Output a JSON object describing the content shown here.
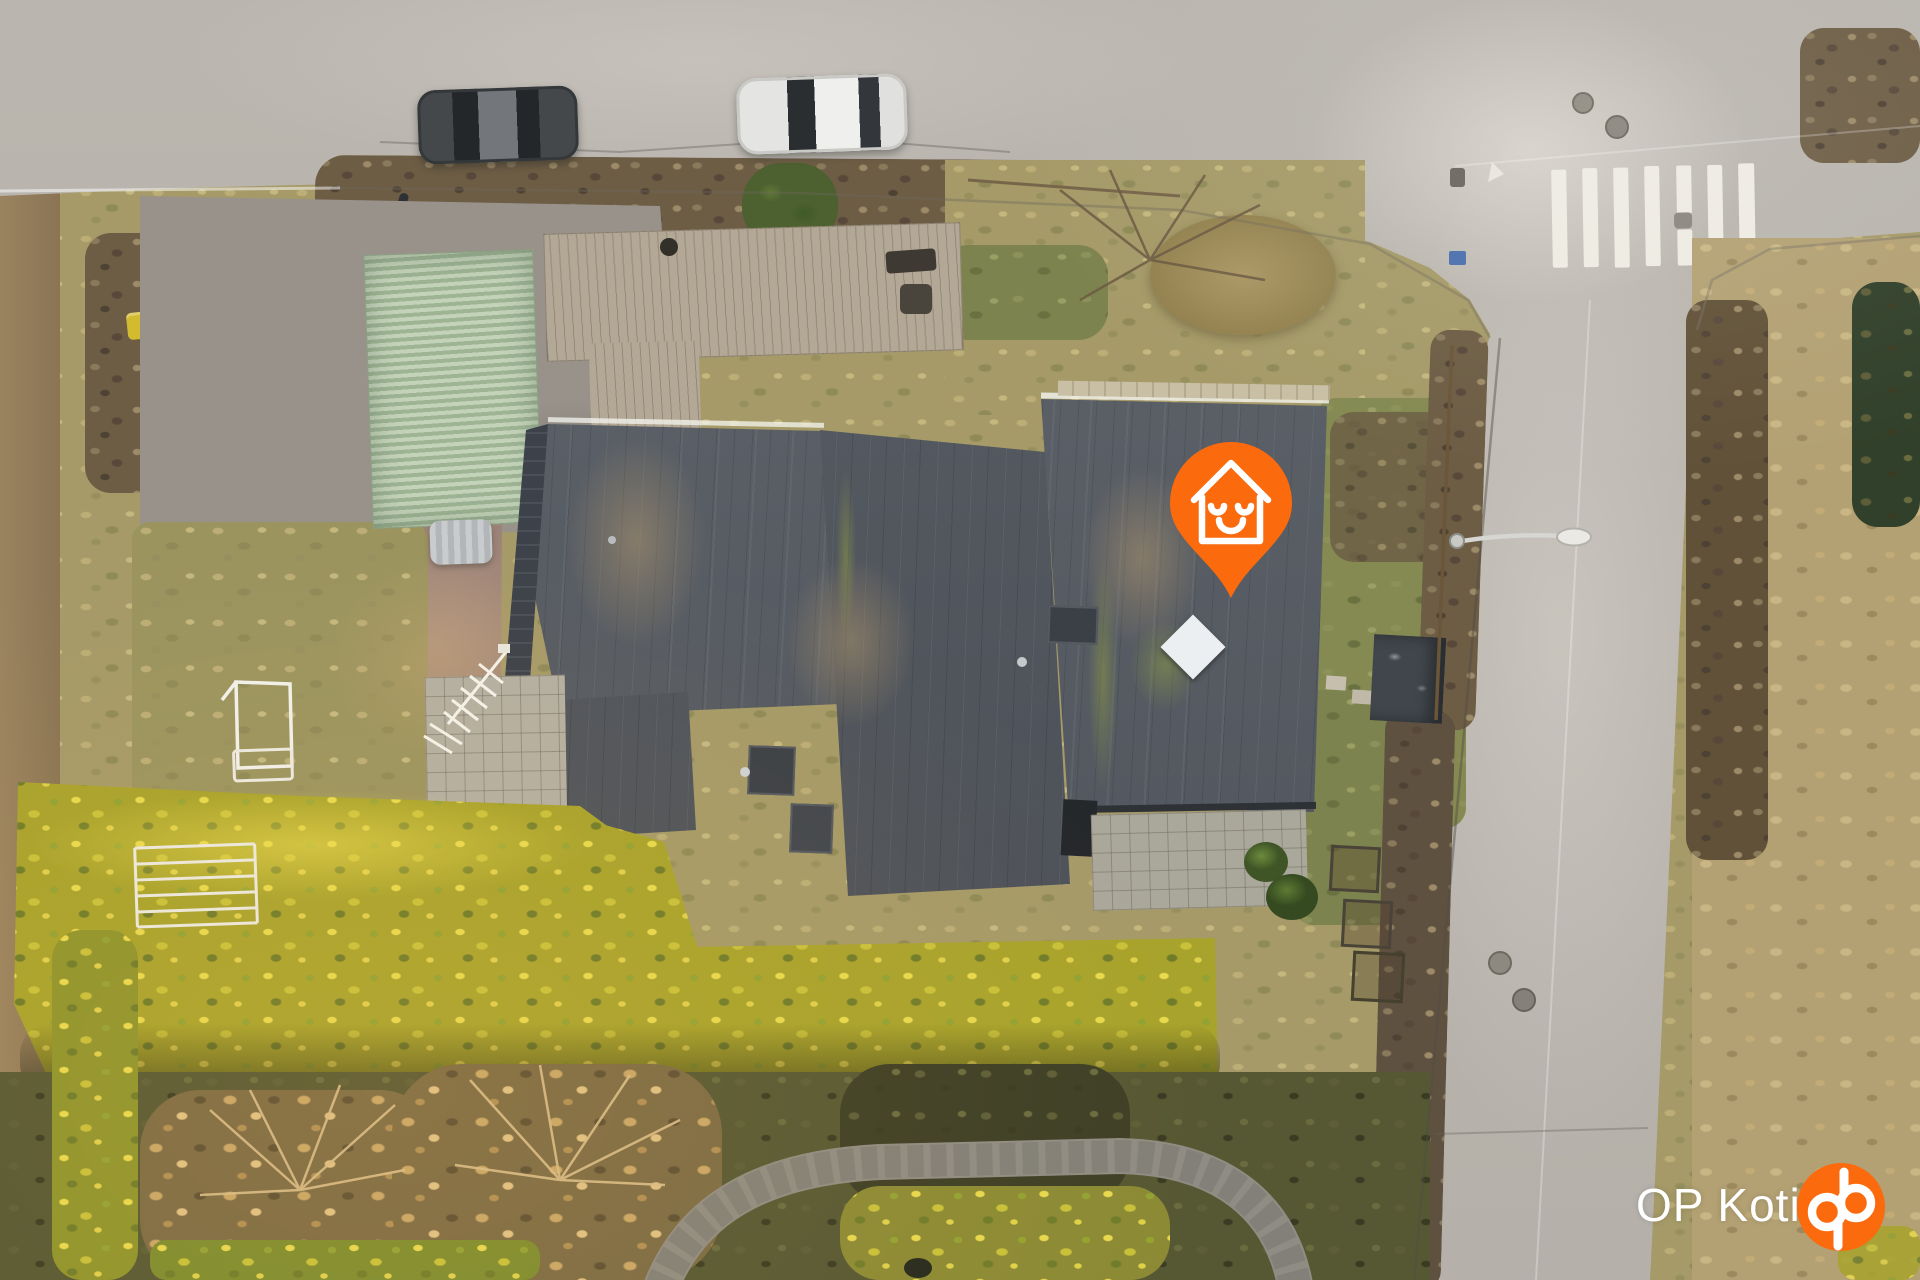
{
  "watermark": {
    "brand_text": "OP Koti",
    "logo_icon": "op-logo",
    "text_color": "#ffffff"
  },
  "map_pin": {
    "icon": "home-smiley-pin-icon",
    "color": "#fb6a0d",
    "glyph_color": "#ffffff"
  },
  "colors": {
    "op_orange": "#fb6a0d",
    "road_asphalt": "#bab6af",
    "roof_dark": "#575c63",
    "roof_green": "#b5c7ac",
    "hedge_yellow": "#d9c430",
    "hedge_brown": "#6d5d45",
    "lawn": "#8b8a55",
    "deck_wood": "#b3a795",
    "crosswalk_white": "#efece4"
  },
  "scene": {
    "objects": [
      "horizontal-street",
      "vertical-street",
      "pedestrian-crossing",
      "parked-car-dark",
      "parked-car-white",
      "main-house-roof",
      "garage-green-roof",
      "wood-deck",
      "gravel-driveway",
      "waste-bins",
      "tv-antenna",
      "front-lawn",
      "yellow-hedge",
      "boundary-hedge",
      "garden-trees",
      "stone-path",
      "garden-shed",
      "street-light",
      "skylight-diamond",
      "location-pin",
      "op-koti-watermark"
    ]
  }
}
